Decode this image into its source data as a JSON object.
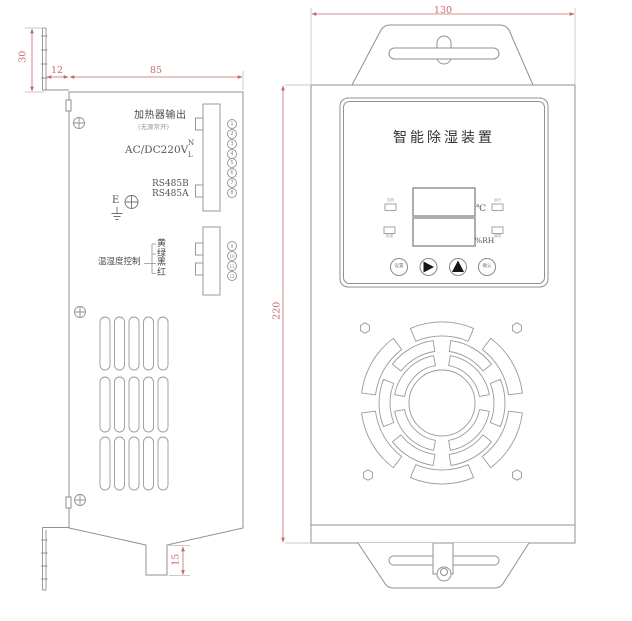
{
  "side_view": {
    "dim_bracket_height": "30",
    "dim_bracket_offset": "12",
    "dim_body_width": "85",
    "dim_drain_length": "15",
    "labels": {
      "heater_output": "加热器输出",
      "heater_note": "(无源常开)",
      "power": "AC/DC220V",
      "power_n": "N",
      "power_l": "L",
      "rs485_b": "RS485B",
      "rs485_a": "RS485A",
      "earth": "E",
      "temp_humidity_control": "温湿度控制"
    },
    "wires": [
      "黄",
      "绿",
      "黑",
      "红"
    ],
    "terminals_block1": [
      "1",
      "2",
      "3",
      "4",
      "5",
      "6",
      "7",
      "8"
    ],
    "terminals_block2": [
      "9",
      "10",
      "11",
      "12"
    ]
  },
  "front_view": {
    "dim_width": "130",
    "dim_height": "220",
    "title": "智能除湿装置",
    "display": {
      "temp_unit": "℃",
      "humidity_unit": "%RH"
    },
    "indicators": [
      {
        "position": "left-top",
        "label": "加热"
      },
      {
        "position": "left-bottom",
        "label": "除湿"
      },
      {
        "position": "right-top",
        "label": "运行"
      },
      {
        "position": "right-bottom",
        "label": "故障"
      }
    ],
    "buttons": [
      {
        "label": "设置"
      },
      {
        "icon": "right-arrow"
      },
      {
        "icon": "up-arrow"
      },
      {
        "label": "确认"
      }
    ]
  },
  "colors": {
    "line": "#909090",
    "dimension": "#c66a6a",
    "text": "#4a4a4a"
  }
}
